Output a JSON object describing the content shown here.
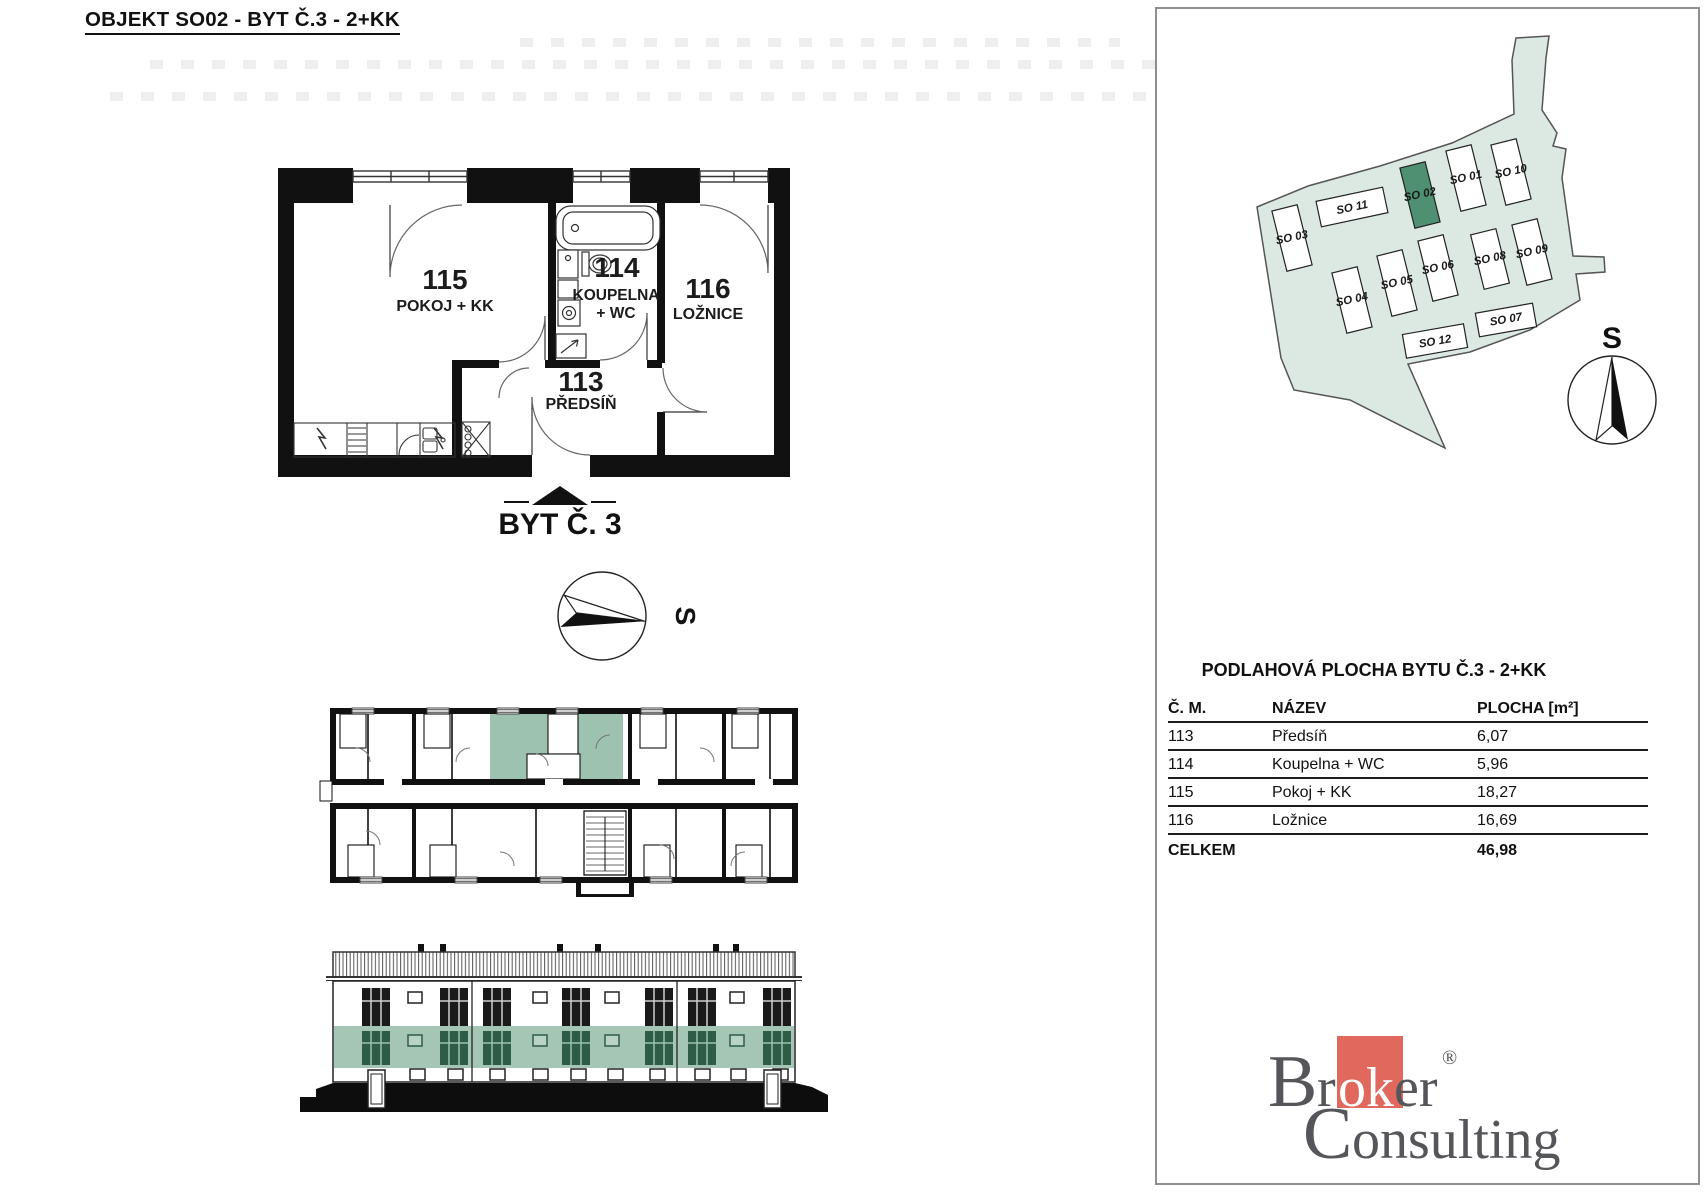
{
  "page": {
    "title": "OBJEKT SO02 - BYT Č.3 - 2+KK"
  },
  "floor_plan": {
    "apartment_label": "BYT Č. 3",
    "compass_label": "S",
    "rooms": [
      {
        "number": "115",
        "label": "POKOJ + KK"
      },
      {
        "number": "114",
        "label": "KOUPELNA",
        "label2": "+ WC"
      },
      {
        "number": "116",
        "label": "LOŽNICE"
      },
      {
        "number": "113",
        "label": "PŘEDSÍŇ"
      }
    ]
  },
  "site_plan": {
    "compass_label": "S",
    "highlighted_building": "SO 02",
    "buildings": [
      {
        "label": "SO 11"
      },
      {
        "label": "SO 02"
      },
      {
        "label": "SO 01"
      },
      {
        "label": "SO 10"
      },
      {
        "label": "SO 03"
      },
      {
        "label": "SO 06"
      },
      {
        "label": "SO 08"
      },
      {
        "label": "SO 09"
      },
      {
        "label": "SO 04"
      },
      {
        "label": "SO 05"
      },
      {
        "label": "SO 12"
      },
      {
        "label": "SO 07"
      }
    ],
    "colors": {
      "area": "#dce9e3",
      "building": "#ffffff",
      "highlight": "#4e9071"
    }
  },
  "area_table": {
    "title": "PODLAHOVÁ PLOCHA BYTU Č.3 - 2+KK",
    "columns": [
      "Č. M.",
      "NÁZEV",
      "PLOCHA [m²]"
    ],
    "rows": [
      {
        "num": "113",
        "name": "Předsíň",
        "area": "6,07"
      },
      {
        "num": "114",
        "name": "Koupelna + WC",
        "area": "5,96"
      },
      {
        "num": "115",
        "name": "Pokoj + KK",
        "area": "18,27"
      },
      {
        "num": "116",
        "name": "Ložnice",
        "area": "16,69"
      }
    ],
    "total_label": "CELKEM",
    "total_value": "46,98"
  },
  "logo": {
    "b": "B",
    "r": "r",
    "ok": "ok",
    "er": "er",
    "reg": "®",
    "c": "C",
    "onsulting": "onsulting",
    "accent_color": "#e0685c",
    "text_color": "#55565a"
  },
  "highlight_colors": {
    "plan_room": "#9dc2af",
    "elevation_floor": "#a6c6b5",
    "elevation_window": "#2d5c47"
  }
}
